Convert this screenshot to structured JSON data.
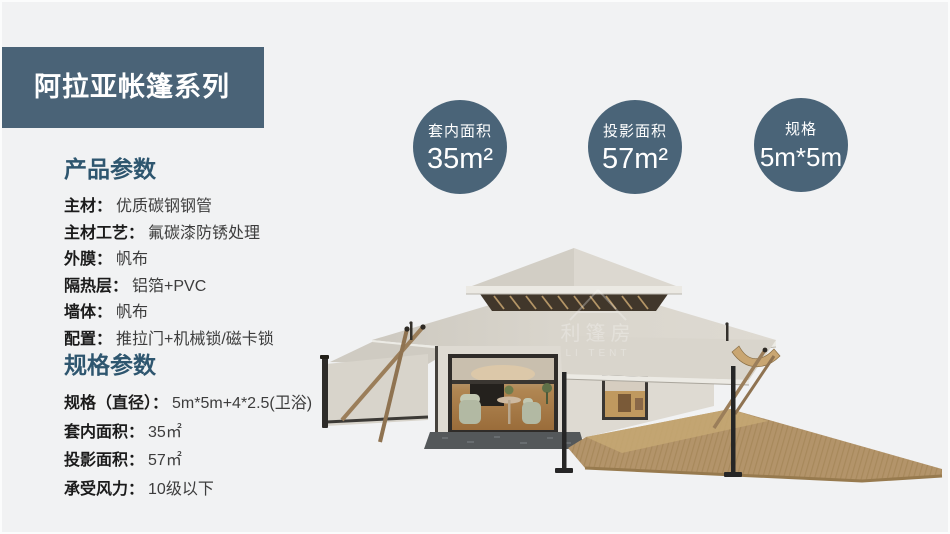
{
  "theme": {
    "background": "#f1f2f3",
    "accent": "#4a6377",
    "heading_color": "#2e566f"
  },
  "banner": {
    "title": "阿拉亚帐篷系列"
  },
  "badges": [
    {
      "label": "套内面积",
      "value": "35m²"
    },
    {
      "label": "投影面积",
      "value": "57m²"
    },
    {
      "label": "规格",
      "value": "5m*5m"
    }
  ],
  "product_params": {
    "heading": "产品参数",
    "rows": [
      {
        "label": "主材：",
        "value": "优质碳钢钢管"
      },
      {
        "label": "主材工艺：",
        "value": "氟碳漆防锈处理"
      },
      {
        "label": "外膜：",
        "value": "帆布"
      },
      {
        "label": "隔热层：",
        "value": "铝箔+PVC"
      },
      {
        "label": "墙体：",
        "value": "帆布"
      },
      {
        "label": "配置：",
        "value": "推拉门+机械锁/磁卡锁"
      }
    ]
  },
  "spec_params": {
    "heading": "规格参数",
    "rows": [
      {
        "label": "规格（直径）：",
        "value": "5m*5m+4*2.5(卫浴)"
      },
      {
        "label": "套内面积：",
        "value": "35㎡"
      },
      {
        "label": "投影面积：",
        "value": "57㎡"
      },
      {
        "label": "承受风力：",
        "value": "10级以下"
      }
    ]
  },
  "tent": {
    "watermark_line1": "利篷房",
    "watermark_line2": "LI TENT"
  }
}
